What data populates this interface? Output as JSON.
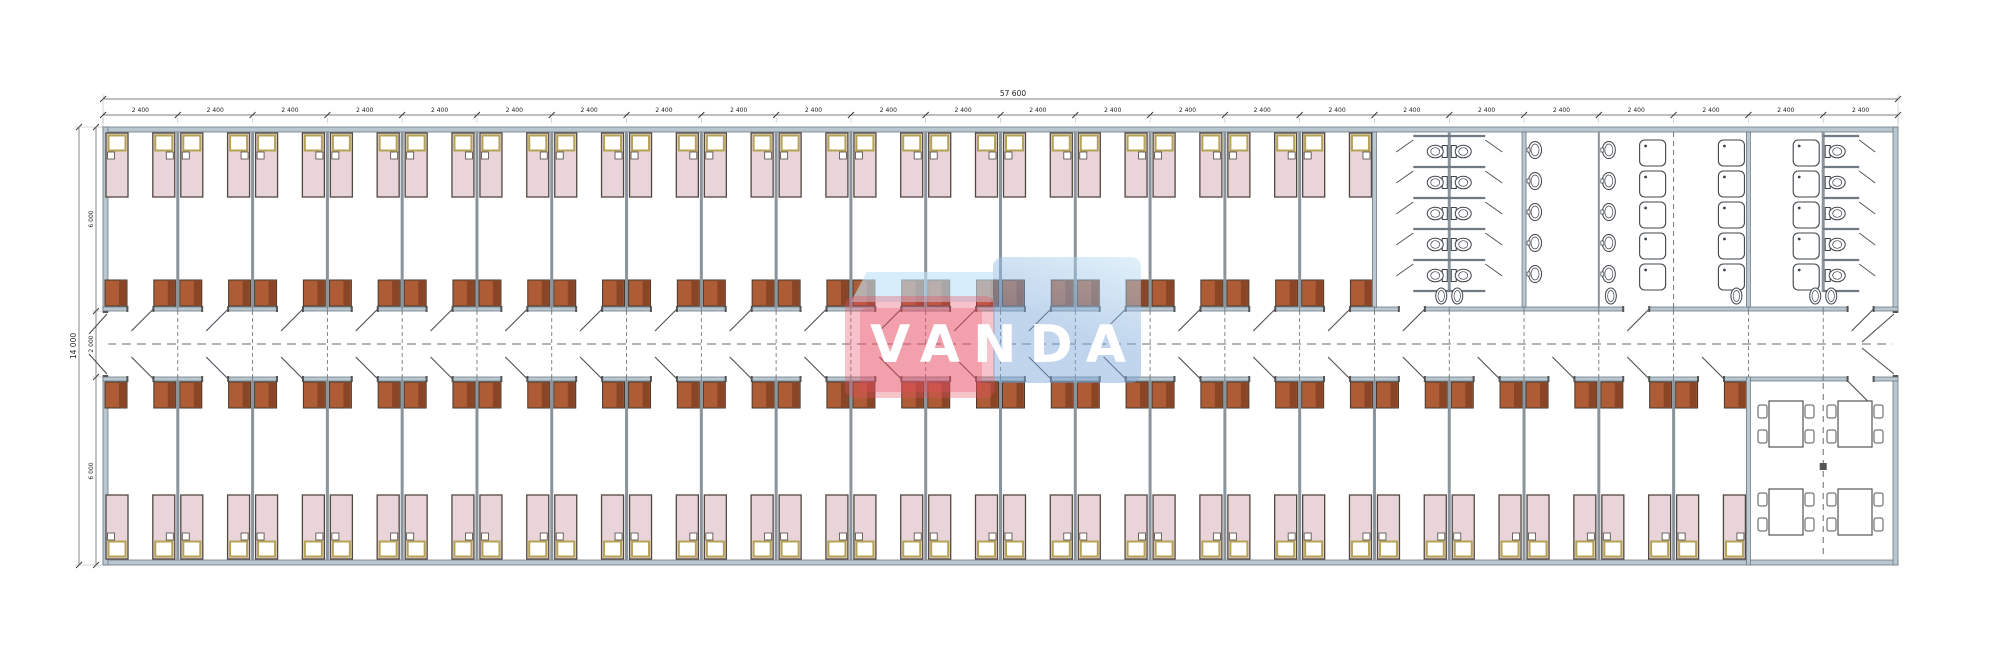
{
  "watermark": {
    "text": "VANDA"
  },
  "dimensions": {
    "overall_width": "57 600",
    "overall_height": "14 000",
    "module_width": "2 400",
    "module_count": 24,
    "height_segments": [
      "6 000",
      "2 000",
      "6 000"
    ]
  },
  "plan": {
    "top_bedroom_count": 17,
    "bottom_bedroom_count": 22,
    "beds_per_room": 2,
    "wardrobes_per_room": 2,
    "sanitary": {
      "wc_stall_rows": 5,
      "basin_columns": 2,
      "basins_per_column": 5,
      "shower_columns": 3,
      "showers_per_column": 5,
      "wc_with_door_count": 5
    },
    "dining": {
      "tables": 4,
      "chairs_per_table": 4
    }
  },
  "colors": {
    "line": "#4a4f55",
    "dim_line": "#555555",
    "dim_text": "#222222",
    "ext_line": "#999999",
    "wall_fill": "#b9c7d1",
    "wall_stroke": "#6f7a84",
    "partition": "#8a949c",
    "bed_fill": "#e8d4d9",
    "bed_stroke": "#514840",
    "pillow_frame": "#b5a355",
    "pillow_fill": "#ffffff",
    "wardrobe_fill": "#ad5c35",
    "wardrobe_dark": "#8a4527",
    "wardrobe_stroke": "#46382c",
    "fixture": "#3f444a",
    "dash": "#666b70",
    "watermark_red": "#e94f63",
    "watermark_blue": "#7da7d9",
    "watermark_band": "#bfe2f5",
    "watermark_text_color": "#ffffff"
  }
}
